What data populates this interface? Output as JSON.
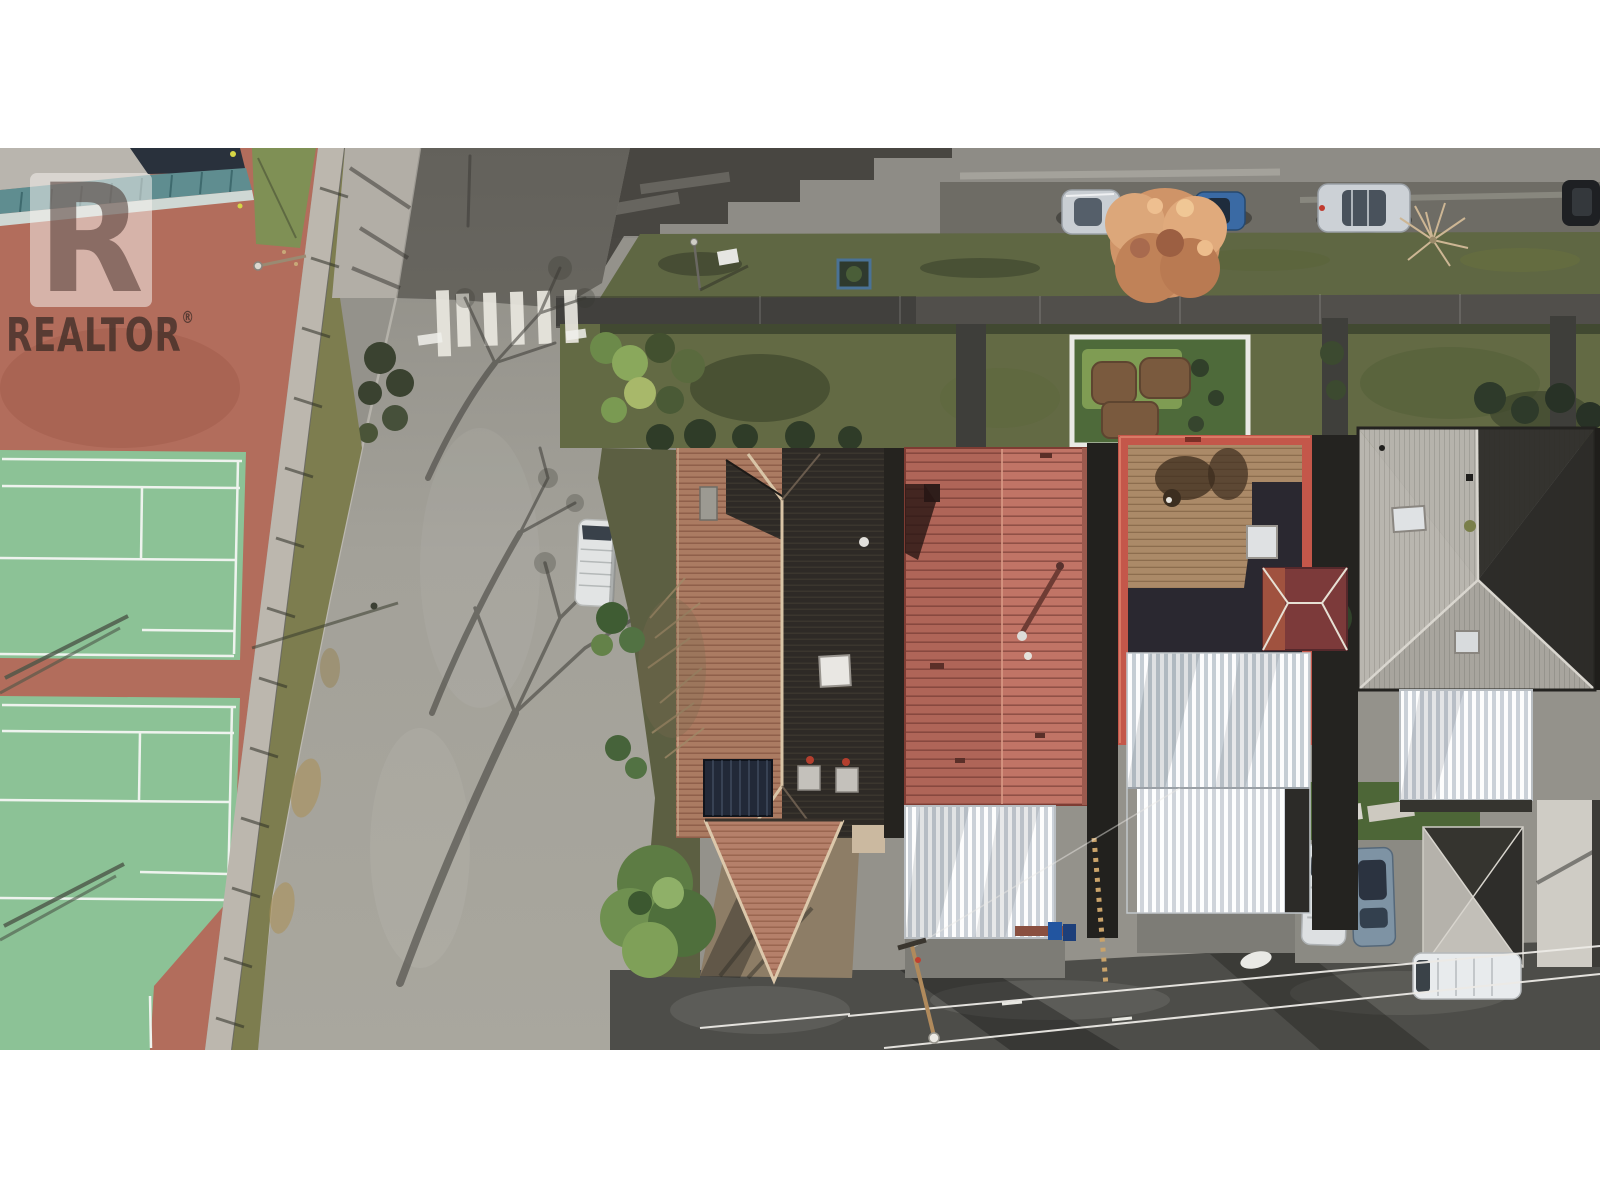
{
  "image": {
    "kind": "aerial-real-estate-photo",
    "orientation": "top-down",
    "letterbox_color": "#ffffff"
  },
  "watermark": {
    "logo_letter": "R",
    "brand": "REALTOR",
    "registered": "®"
  },
  "palette": {
    "court_surround": "#b26d5c",
    "court_green": "#8cc296",
    "street_asphalt": "#9d9b94",
    "shadow_asphalt": "#47463f",
    "boulevard_grass": "#5f6743",
    "tiled_roof_sunlit": "#ab7b62",
    "tiled_roof_shadow": "#2e2a26",
    "red_metal_roof": "#c17466",
    "flat_roof_parapet": "#c4574a",
    "roof_deck_brown": "#ab8a68",
    "gray_hip_roof": "#a8a59e",
    "awning_white": "#e8ebee",
    "rear_lane": "#4d4d49",
    "autumn_tree": "#cf9468"
  },
  "scene": {
    "left": "tennis courts with red surround and clubhouse glass roof",
    "center": "curved residential street with zebra crosswalk and parked white van",
    "right": "row of houses: clay tiled roof, red metal roof, flat deck roof, gray hip roof, white carport awnings",
    "bottom": "rear lane with utility pole, power lines, garage and parked cars",
    "top": "street with parked cars, grass boulevard and front gardens"
  }
}
